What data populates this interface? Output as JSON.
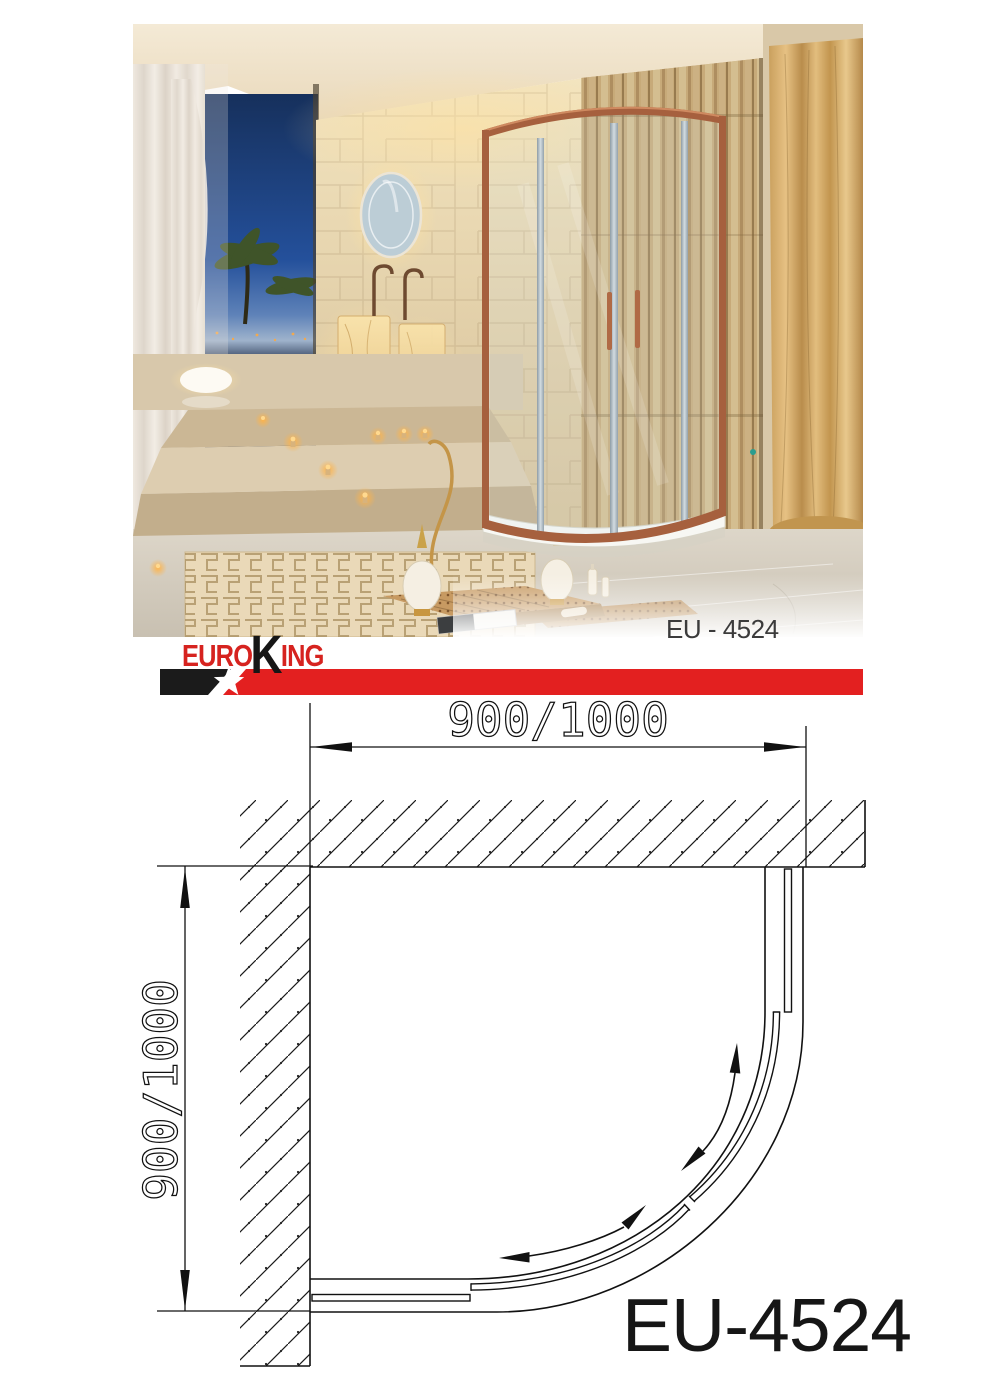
{
  "photo": {
    "caption": "EU - 4524"
  },
  "brand": {
    "euro": "EURO",
    "k": "K",
    "ing": "ING"
  },
  "banner": {
    "red": "#e32020",
    "black": "#1b1b1b"
  },
  "diagram": {
    "width_label": "900/1000",
    "depth_label": "900/1000",
    "model": "EU-4524"
  }
}
